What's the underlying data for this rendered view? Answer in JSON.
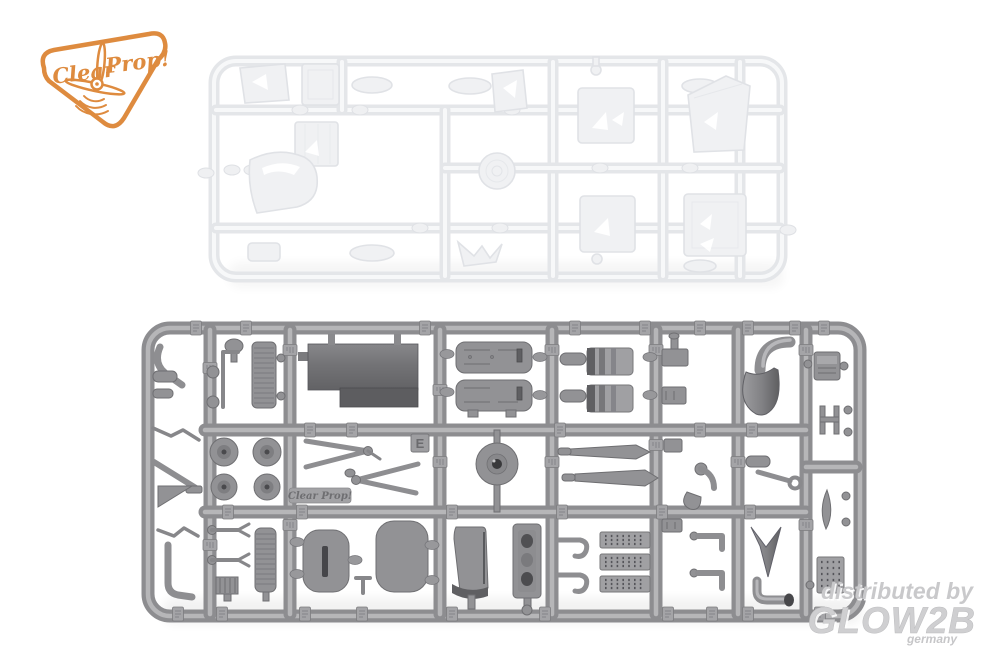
{
  "brand_logo": {
    "word1": "Clear",
    "word2": "Prop!",
    "color": "#de8b3f"
  },
  "gray_sprue": {
    "gate_letter": "E",
    "emboss_text": "Clear Prop!",
    "plastic_color": "#97979a"
  },
  "clear_sprue": {
    "outline_color": "#e4e6e9"
  },
  "watermark": {
    "line1": "distributed by",
    "line2": "GLOW2B",
    "line3": "germany",
    "color": "#cbcbcd"
  }
}
